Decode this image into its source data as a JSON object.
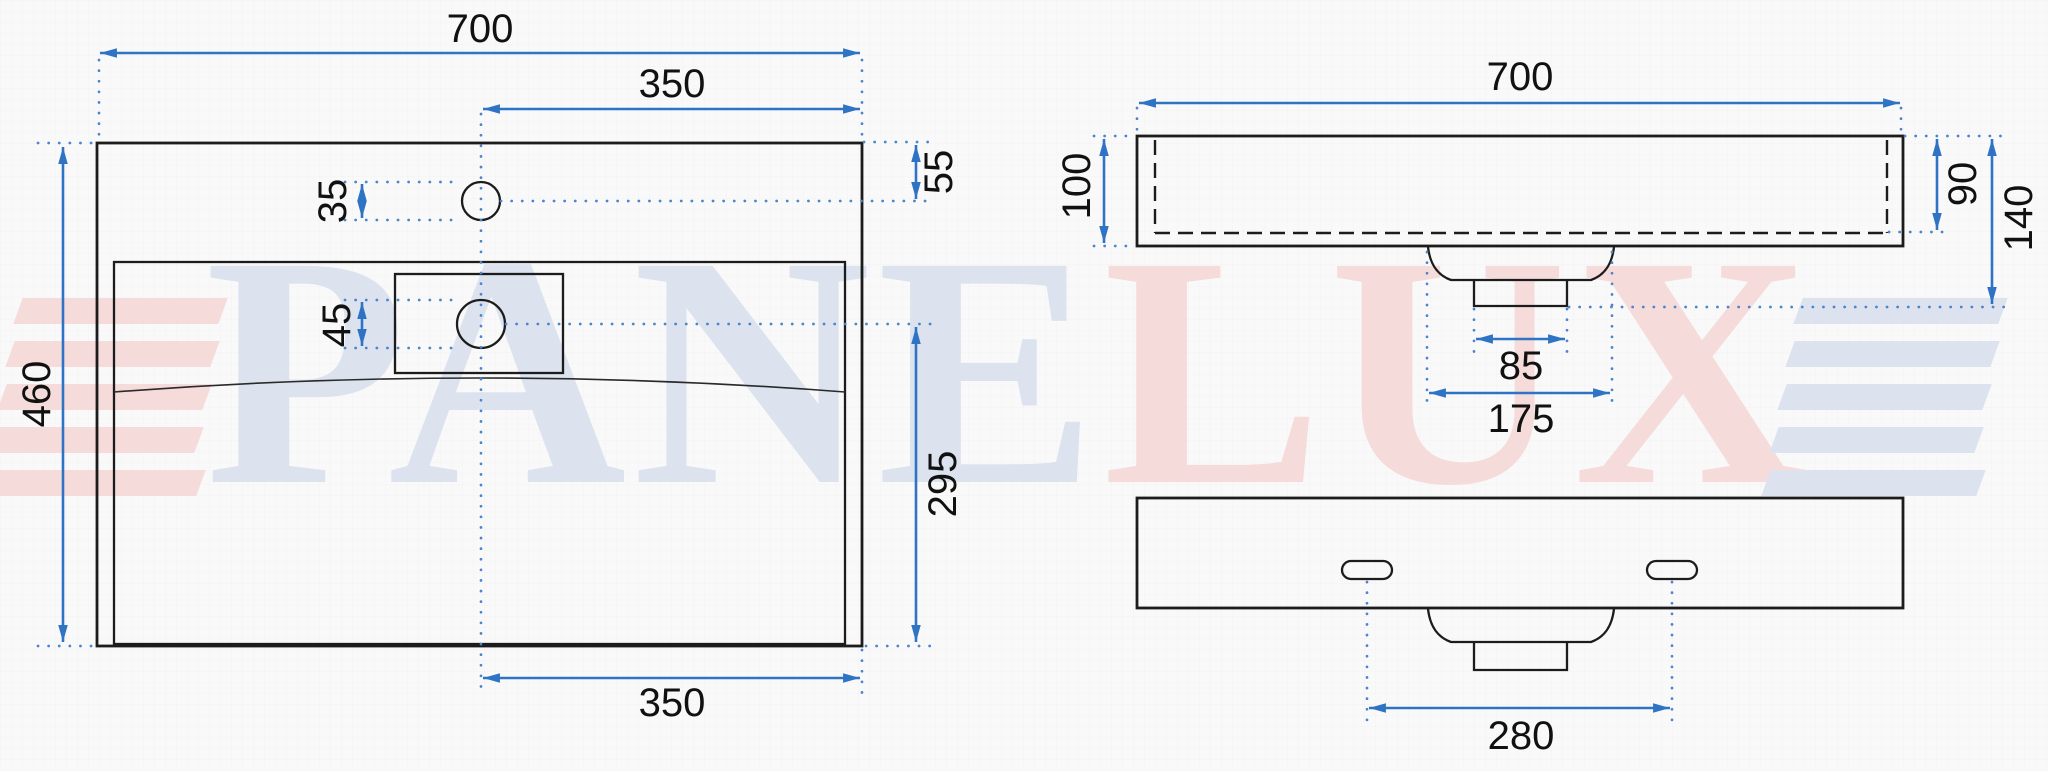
{
  "drawing_title": "washbasin dimension drawing",
  "colors": {
    "dimension_blue": "#2f74c4",
    "outline_black": "#1c1c1c",
    "watermark_blue": "#dce3ef",
    "watermark_red": "#f6dbdb",
    "background": "#f9f9f9"
  },
  "watermark": {
    "text": "PANELUX",
    "letters": [
      {
        "ch": "P",
        "tone": "blue"
      },
      {
        "ch": "A",
        "tone": "blue"
      },
      {
        "ch": "N",
        "tone": "blue"
      },
      {
        "ch": "E",
        "tone": "blue"
      },
      {
        "ch": "L",
        "tone": "red"
      },
      {
        "ch": "U",
        "tone": "red"
      },
      {
        "ch": "X",
        "tone": "red"
      }
    ]
  },
  "top_view": {
    "overall_width": "700",
    "center_to_right_edge_top": "350",
    "top_edge_to_faucet_hole": "55",
    "faucet_hole_diameter": "35",
    "overflow_hole_diameter": "45",
    "overall_depth": "460",
    "overflow_to_front_edge": "295",
    "center_to_right_edge_bottom": "350"
  },
  "front_view": {
    "overall_width": "700",
    "edge_height": "100",
    "inner_basin_depth": "90",
    "total_height_with_drain": "140",
    "drain_outlet_width": "85",
    "drain_flange_width": "175"
  },
  "bottom_view": {
    "mounting_slot_spacing": "280"
  }
}
